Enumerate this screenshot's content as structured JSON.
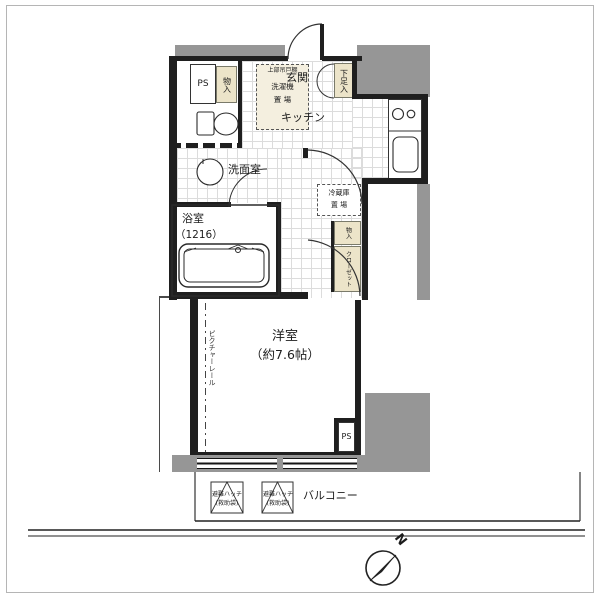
{
  "rooms": {
    "genkan": "玄関",
    "kitchen": "キッチン",
    "washroom": "洗面室",
    "bathroom": "浴室",
    "bathroom_size": "（1216）",
    "western_room": "洋室",
    "western_room_size": "（約7.6帖）",
    "balcony": "バルコニー"
  },
  "storage": {
    "ps_top": "PS",
    "ps_bottom": "PS",
    "monoire": "物入",
    "shoe_box": "下足入",
    "upper_cabinet": "上部吊戸棚",
    "washer_line1": "洗濯機",
    "washer_line2": "置 場",
    "fridge_line1": "冷蔵庫",
    "fridge_line2": "置 場",
    "closet_upper": "物入",
    "closet_lower": "クローゼット",
    "picture_rail": "ピクチャーレール"
  },
  "balcony_items": {
    "hatch1_line1": "避難ハッチ",
    "hatch1_line2": "(救助袋)",
    "hatch2_line1": "避難ハッチ",
    "hatch2_line2": "(救助袋)"
  },
  "compass": {
    "north_label": "N"
  },
  "colors": {
    "wall": "#1f1f1f",
    "structure_gray": "#969696",
    "cabinet_tan": "#ece4c9",
    "floor_grid": "#dcdcdc"
  }
}
